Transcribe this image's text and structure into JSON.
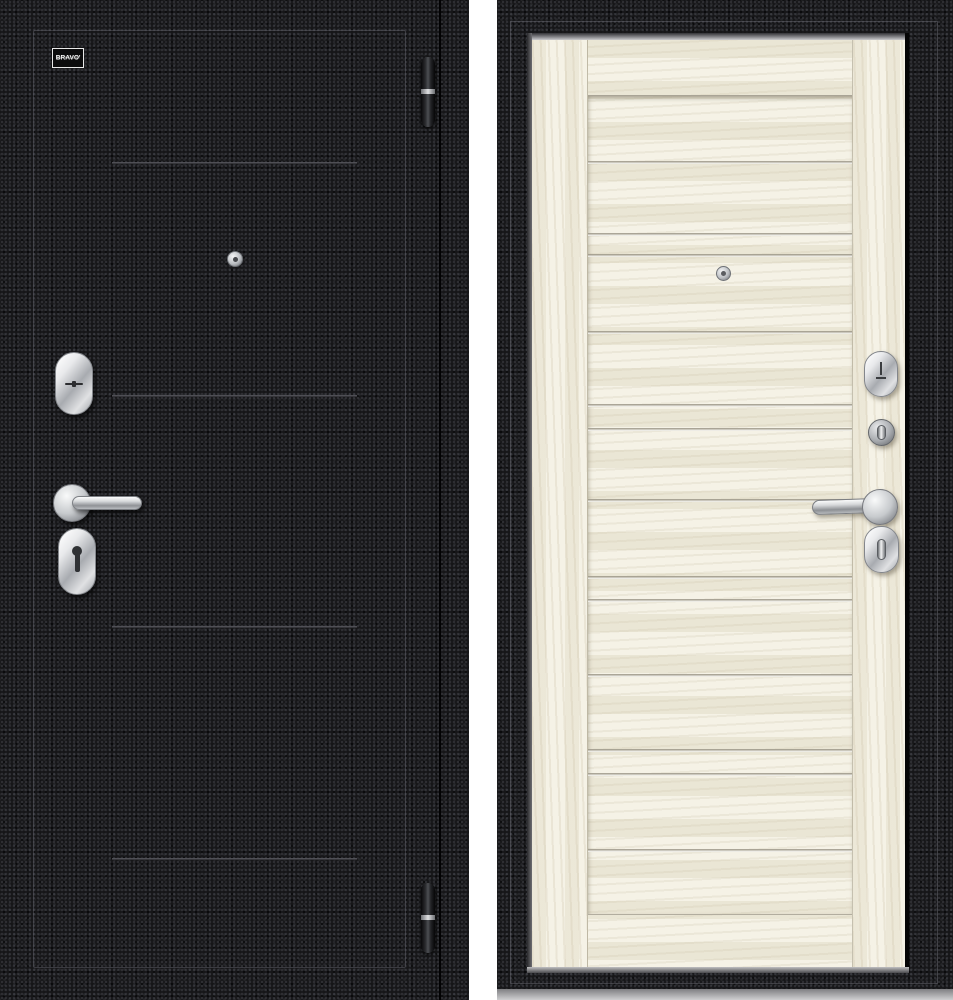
{
  "image": {
    "description": "Steel entrance door product photo, exterior and interior sides shown side by side",
    "background_hex": "#ffffff"
  },
  "brand": {
    "name": "BRAVO'",
    "tagline": "ФАБРИКА ДВЕРЕЙ"
  },
  "left_door": {
    "side_label": "exterior-black-crinkle",
    "finish_hex": "#161618",
    "groove_line_color_hex": "#5f5f65",
    "groove_lines_y": [
      162,
      395,
      626,
      858
    ],
    "hinges_y": [
      57,
      883
    ],
    "hardware": [
      "peephole",
      "oval-cylinder-escutcheon",
      "lever-handle",
      "oval-keyhole-escutcheon",
      "hinge",
      "hinge"
    ]
  },
  "right_door": {
    "side_label": "interior-light-wood",
    "frame_hex": "#1b1b1d",
    "wood_hex": "#f0ecdd",
    "panel_groove_lines_y": [
      160,
      232,
      253,
      330,
      403,
      427,
      498,
      575,
      598,
      673,
      748,
      772,
      848
    ],
    "hardware": [
      "peephole",
      "oval-cylinder-escutcheon",
      "night-latch-turn",
      "lever-handle",
      "oval-thumbturn-escutcheon"
    ]
  }
}
